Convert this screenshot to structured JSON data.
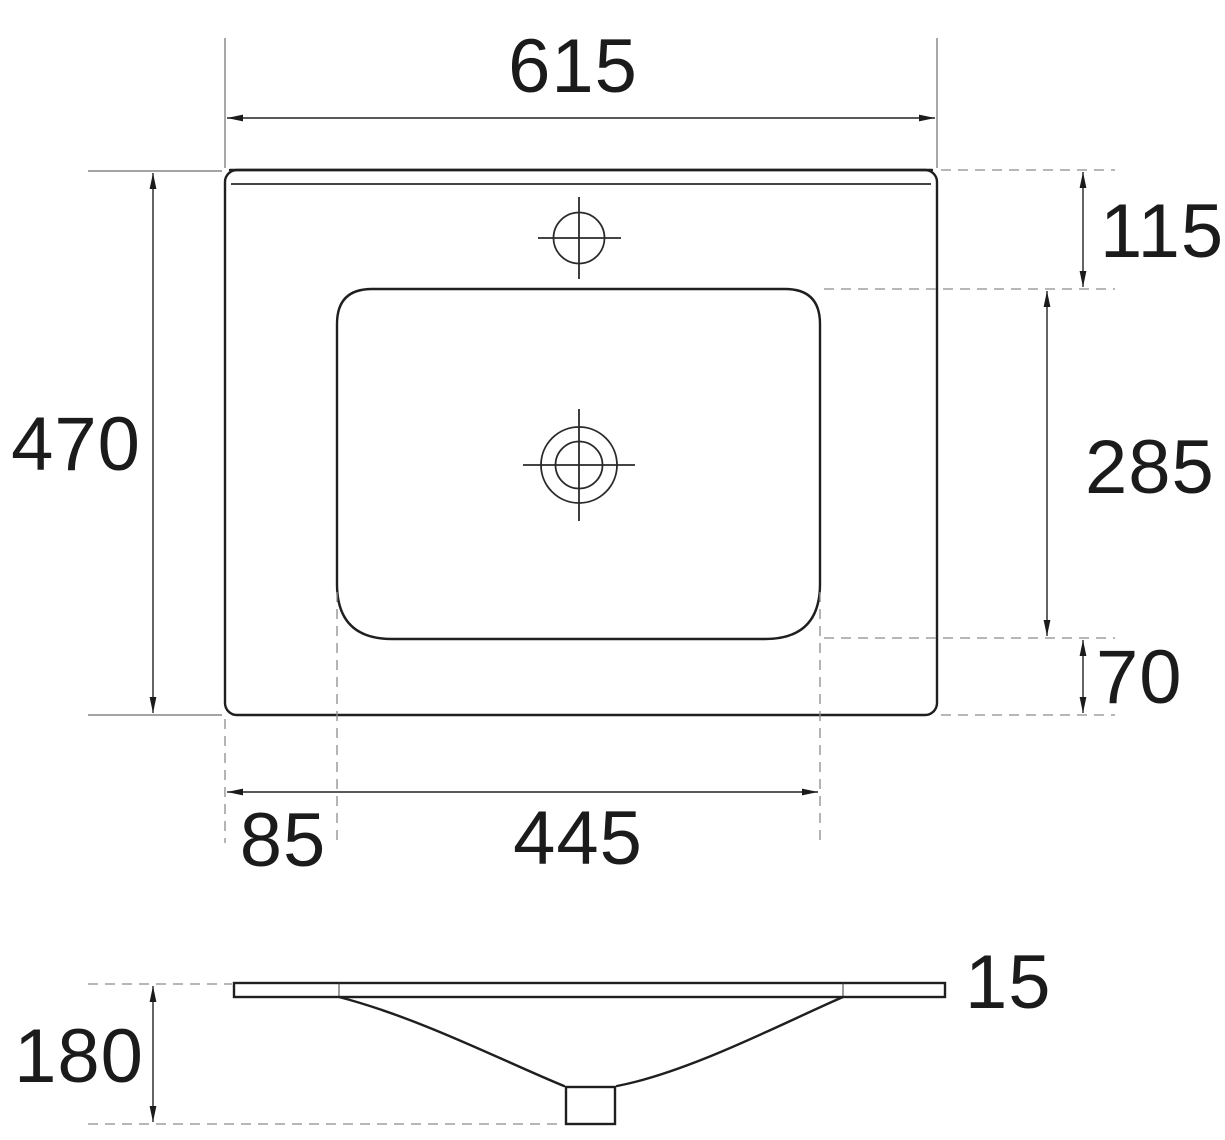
{
  "drawing": {
    "top_view": {
      "width": "615",
      "height": "470",
      "offset_top": "115",
      "basin_height": "285",
      "offset_bottom": "70",
      "offset_left": "85",
      "basin_width": "445"
    },
    "side_view": {
      "thickness": "15",
      "depth": "180"
    }
  }
}
